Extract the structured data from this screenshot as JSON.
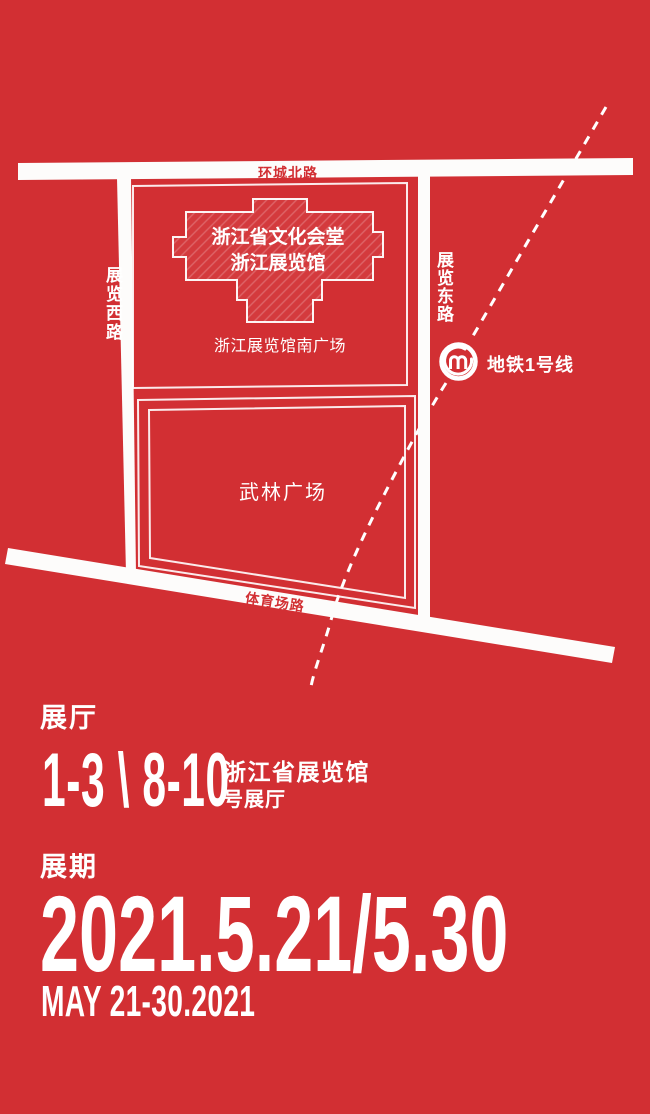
{
  "colors": {
    "background": "#d22f33",
    "road": "#ffffff",
    "text": "#ffffff"
  },
  "map": {
    "road_north": "环城北路",
    "road_west": "展览西路",
    "road_east": "展览东路",
    "road_south": "体育场路",
    "building_line1": "浙江省文化会堂",
    "building_line2": "浙江展览馆",
    "south_square": "浙江展览馆南广场",
    "wulin_square": "武林广场",
    "metro_label": "地铁1号线",
    "metro_icon": "metro-logo-icon"
  },
  "info": {
    "hall_heading": "展厅",
    "hall_numbers": "1-3 \\ 8-10",
    "venue_line1": "浙江省展览馆",
    "venue_line2": "号展厅",
    "period_heading": "展期",
    "date_main": "2021.5.21/5.30",
    "date_en": "MAY 21-30.2021"
  }
}
